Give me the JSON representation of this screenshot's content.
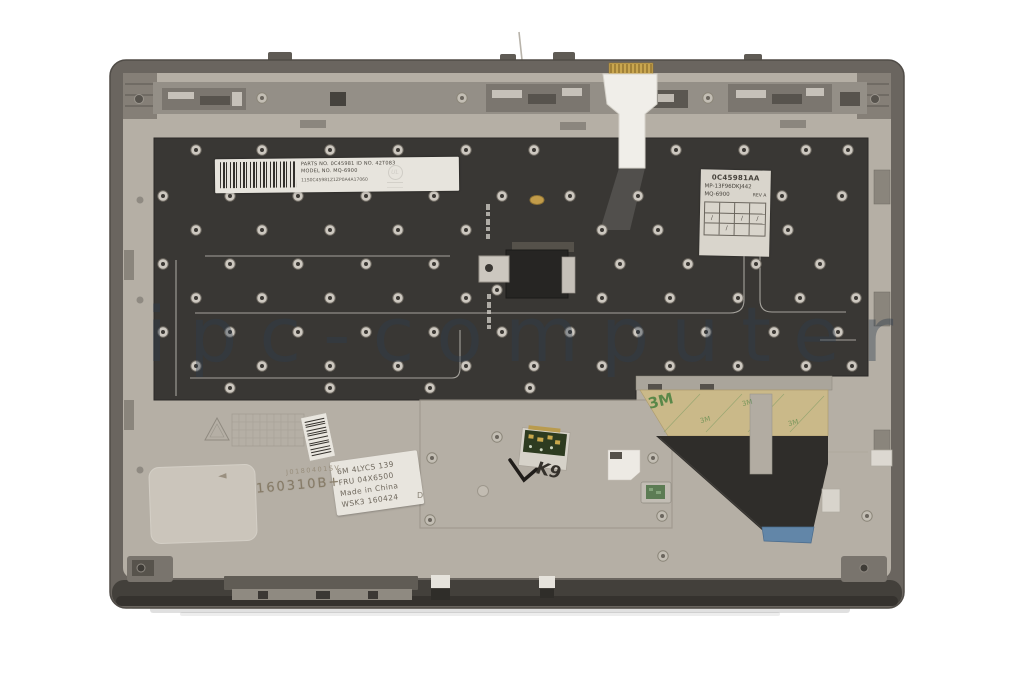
{
  "watermark": "ipc-computer",
  "labels": {
    "barcode_label": {
      "line1": "PARTS NO. 0C45981  ID NO. 42T083",
      "line2": "MODEL NO. MQ-6900",
      "line3": "11S0C45981Z1ZP0A4A17060"
    },
    "ul_mark": "UL",
    "spec_label": {
      "part_number": "0C45981AA",
      "model": "MP-13F96DKJ442",
      "type": "MQ-6900",
      "rev": "REV A",
      "marks": [
        "",
        "",
        "",
        "",
        "∕",
        "",
        "∕",
        "∕",
        "",
        "∕",
        "",
        ""
      ]
    },
    "fru_label": {
      "line1": "6M 4LYCS 139",
      "line2": "FRU  04X6500",
      "line3": "Made in China",
      "line4": "WSK3 160424"
    },
    "stamps": {
      "serial_small": "J0180401SV",
      "date_code": "160310B+",
      "arrow": "◄",
      "letter_d": "D"
    },
    "handwritten": "K9",
    "tape_brand": "3M"
  },
  "colors": {
    "background": "#ffffff",
    "case_light": "#b5afa5",
    "case_rim": "#6a655f",
    "plate_dark": "#393734",
    "tape_tan": "#cab989",
    "tape_text_green": "#47803f",
    "ribbon_black": "#2f2d2a",
    "ribbon_end_blue": "#6286a8",
    "pcb_green": "#2d3b20",
    "watermark_color": "rgba(45,60,78,0.40)"
  }
}
